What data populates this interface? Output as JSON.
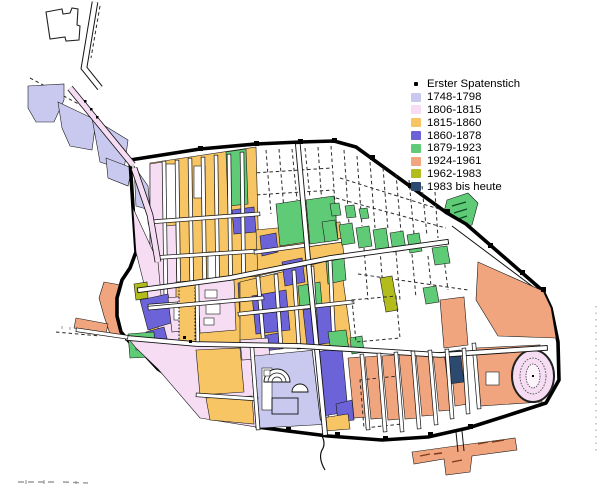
{
  "legend": {
    "items": [
      {
        "key": "spatenstich",
        "label": "Erster Spatenstich",
        "marker": "dot",
        "color": "#000000"
      },
      {
        "key": "p1748",
        "label": "1748-1798",
        "marker": "swatch",
        "color": "#c9c9f0"
      },
      {
        "key": "p1806",
        "label": "1806-1815",
        "marker": "swatch",
        "color": "#f6ddf4"
      },
      {
        "key": "p1815",
        "label": "1815-1860",
        "marker": "swatch",
        "color": "#f8c565"
      },
      {
        "key": "p1860",
        "label": "1860-1878",
        "marker": "swatch",
        "color": "#6c63d8"
      },
      {
        "key": "p1879",
        "label": "1879-1923",
        "marker": "swatch",
        "color": "#5fcb76"
      },
      {
        "key": "p1924",
        "label": "1924-1961",
        "marker": "swatch",
        "color": "#f0a57f"
      },
      {
        "key": "p1962",
        "label": "1962-1983",
        "marker": "swatch",
        "color": "#b2bd1b"
      },
      {
        "key": "p1983",
        "label": "1983 bis heute",
        "marker": "swatch",
        "color": "#2c4a70"
      }
    ]
  },
  "map": {
    "wall_color": "#000000",
    "street_color": "#ffffff",
    "unexcavated_color": "#ffffff",
    "block_outline_color": "#1b1b1b"
  }
}
